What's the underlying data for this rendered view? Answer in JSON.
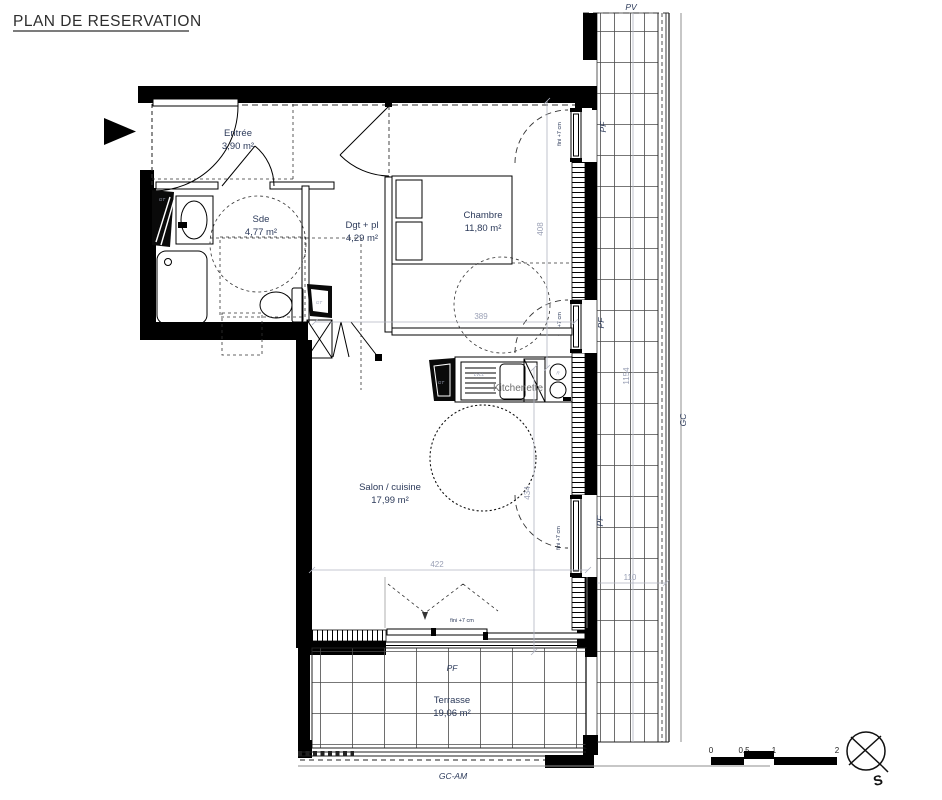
{
  "title": "PLAN DE RESERVATION",
  "rooms": {
    "entree": {
      "name": "Entrée",
      "area": "3,90 m²"
    },
    "sde": {
      "name": "Sde",
      "area": "4,77 m²"
    },
    "dgt": {
      "name": "Dgt + pl",
      "area": "4,29 m²"
    },
    "chambre": {
      "name": "Chambre",
      "area": "11,80 m²"
    },
    "salon": {
      "name": "Salon / cuisine",
      "area": "17,99 m²"
    },
    "terrasse": {
      "name": "Terrasse",
      "area": "19,06 m²"
    }
  },
  "dimensions": {
    "chambre_depth": "408",
    "zone_width": "389",
    "salon_width": "422",
    "salon_depth": "434",
    "loggia_length": "1154",
    "loggia_width": "110"
  },
  "annotations": {
    "pv": "PV",
    "pf": "PF",
    "gc": "GC",
    "gc_am": "GC-AM",
    "fini": "fini +7 cm",
    "kitchenette": "Kitchenette",
    "lvll": "LVLL",
    "gt": "GT",
    "hob_r": "R",
    "south": "S"
  },
  "scale_bar": {
    "labels": [
      "0",
      "0.5",
      "1",
      "2"
    ]
  },
  "colors": {
    "label_navy": "#2c3a5a",
    "dim_gray": "#9aa0b5",
    "wall_black": "#000000"
  }
}
